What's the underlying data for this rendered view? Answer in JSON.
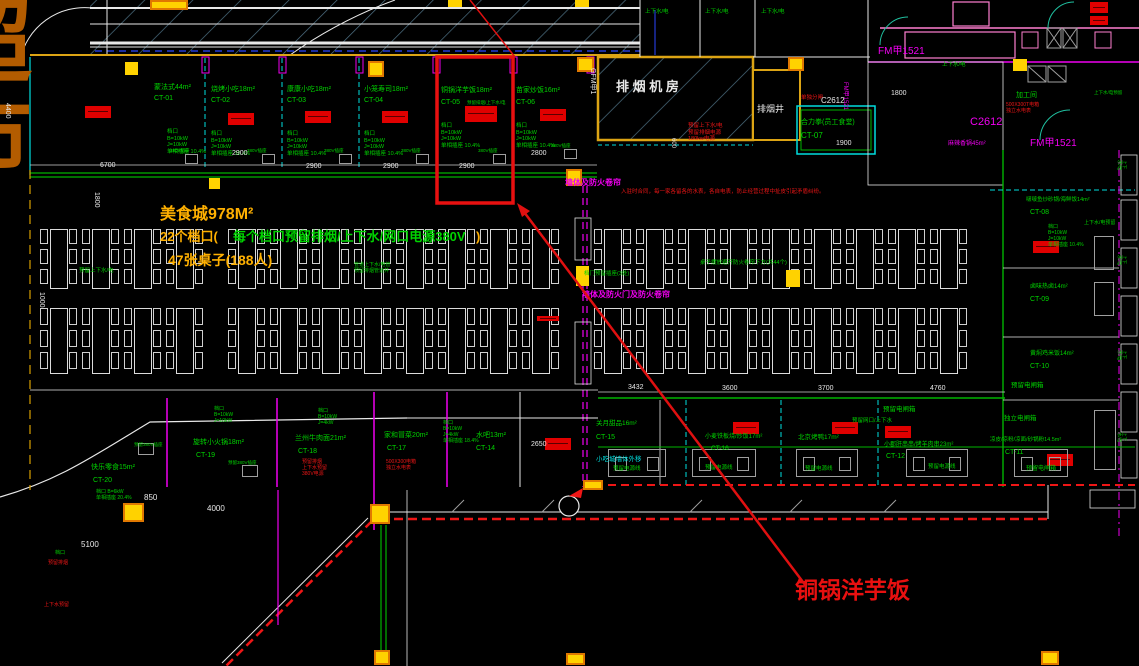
{
  "plan": {
    "width": 1139,
    "height": 666,
    "type": "food-court-floorplan"
  },
  "colors": {
    "green": "#00d300",
    "cyan": "#00dede",
    "magenta": "#f000f0",
    "red": "#ef1616",
    "white": "#e8e8e8",
    "yellow": "#ffb000",
    "orange": "#b35c00",
    "gray": "#b0b0b0",
    "pink": "#ff7fd0",
    "blue": "#2b46ff",
    "hatch": "#4f7386",
    "wall": "#dca414",
    "accent_red": "#e81010",
    "teal": "#20c0a0"
  },
  "highlight": {
    "stall": "铜锅洋芋饭",
    "box": {
      "x": 437,
      "y": 57,
      "w": 76,
      "h": 146
    }
  },
  "annotations": [
    {
      "n": "supermarket-char-1",
      "t": "超",
      "x": -60,
      "y": -12,
      "c": "orange",
      "s": 92,
      "b": true
    },
    {
      "n": "supermarket-char-2",
      "t": "市",
      "x": -60,
      "y": 84,
      "c": "orange",
      "s": 92,
      "b": true
    },
    {
      "n": "summary-line1",
      "t": "美食城978M²",
      "x": 160,
      "y": 205,
      "c": "yellow",
      "s": 16,
      "b": true
    },
    {
      "n": "summary-line2-prefix",
      "t": "22个档口(",
      "x": 160,
      "y": 229,
      "c": "yellow",
      "s": 13,
      "b": true
    },
    {
      "n": "summary-line2-green",
      "t": "每个档口预留排烟/上下水/网口电源380V",
      "x": 233,
      "y": 229,
      "c": "green",
      "s": 13,
      "b": true
    },
    {
      "n": "summary-line2-suffix",
      "t": ")",
      "x": 476,
      "y": 229,
      "c": "yellow",
      "s": 13,
      "b": true
    },
    {
      "n": "summary-line3",
      "t": "47张桌子(188人)",
      "x": 168,
      "y": 252,
      "c": "yellow",
      "s": 14,
      "b": true
    },
    {
      "n": "callout-label",
      "t": "铜锅洋芋饭",
      "x": 795,
      "y": 577,
      "c": "accent_red",
      "s": 23,
      "b": true
    },
    {
      "n": "stall-ct01-name",
      "t": "蒙法式44m²",
      "x": 154,
      "y": 84,
      "c": "green",
      "s": 7
    },
    {
      "n": "stall-ct01-code",
      "t": "CT-01",
      "x": 154,
      "y": 95,
      "c": "green",
      "s": 7
    },
    {
      "n": "stall-ct01-spec",
      "t": "档口\nB=10kW\nJ=10kW\n单相插座 10.4%",
      "x": 167,
      "y": 129,
      "c": "green",
      "s": 5.5
    },
    {
      "n": "stall-ct02-name",
      "t": "烧烤小吃18m²",
      "x": 211,
      "y": 86,
      "c": "green",
      "s": 7
    },
    {
      "n": "stall-ct02-code",
      "t": "CT-02",
      "x": 211,
      "y": 97,
      "c": "green",
      "s": 7
    },
    {
      "n": "stall-ct02-spec",
      "t": "档口\nB=10kW\nJ=10kW\n单相插座 10.4%",
      "x": 211,
      "y": 131,
      "c": "green",
      "s": 5.5
    },
    {
      "n": "stall-ct03-name",
      "t": "康康小吃18m²",
      "x": 287,
      "y": 86,
      "c": "green",
      "s": 7
    },
    {
      "n": "stall-ct03-code",
      "t": "CT-03",
      "x": 287,
      "y": 97,
      "c": "green",
      "s": 7
    },
    {
      "n": "stall-ct03-spec",
      "t": "档口\nB=10kW\nJ=10kW\n单相插座 10.4%",
      "x": 287,
      "y": 131,
      "c": "green",
      "s": 5.5
    },
    {
      "n": "stall-ct04-name",
      "t": "小笼寿司18m²",
      "x": 364,
      "y": 86,
      "c": "green",
      "s": 7
    },
    {
      "n": "stall-ct04-code",
      "t": "CT-04",
      "x": 364,
      "y": 97,
      "c": "green",
      "s": 7
    },
    {
      "n": "stall-ct04-spec",
      "t": "档口\nB=10kW\nJ=10kW\n单相插座 10.4%",
      "x": 364,
      "y": 131,
      "c": "green",
      "s": 5.5
    },
    {
      "n": "stall-ct05-name",
      "t": "铜锅洋芋饭18m²",
      "x": 441,
      "y": 87,
      "c": "green",
      "s": 7
    },
    {
      "n": "stall-ct05-code",
      "t": "CT-05",
      "x": 441,
      "y": 99,
      "c": "green",
      "s": 7
    },
    {
      "n": "stall-ct05-note",
      "t": "预留排烟/上下水/电",
      "x": 467,
      "y": 100,
      "c": "green",
      "s": 4.5
    },
    {
      "n": "stall-ct05-spec",
      "t": "档口\nB=10kW\nJ=10kW\n单相插座 10.4%",
      "x": 441,
      "y": 123,
      "c": "green",
      "s": 5.5
    },
    {
      "n": "stall-ct06-name",
      "t": "苗家炒饭16m²",
      "x": 516,
      "y": 87,
      "c": "green",
      "s": 7
    },
    {
      "n": "stall-ct06-code",
      "t": "CT-06",
      "x": 516,
      "y": 99,
      "c": "green",
      "s": 7
    },
    {
      "n": "stall-ct06-spec",
      "t": "档口\nB=10kW\nJ=10kW\n单相插座 10.4%",
      "x": 516,
      "y": 123,
      "c": "green",
      "s": 5.5
    },
    {
      "n": "socket-label-1",
      "t": "380V插座",
      "x": 170,
      "y": 148,
      "c": "green",
      "s": 4.5
    },
    {
      "n": "socket-label-2",
      "t": "380V插座",
      "x": 247,
      "y": 148,
      "c": "green",
      "s": 4.5
    },
    {
      "n": "socket-label-3",
      "t": "380V插座",
      "x": 324,
      "y": 148,
      "c": "green",
      "s": 4.5
    },
    {
      "n": "socket-label-4",
      "t": "380V插座",
      "x": 401,
      "y": 148,
      "c": "green",
      "s": 4.5
    },
    {
      "n": "socket-label-5",
      "t": "380V插座",
      "x": 478,
      "y": 148,
      "c": "green",
      "s": 4.5
    },
    {
      "n": "socket-label-6",
      "t": "380V插座",
      "x": 551,
      "y": 143,
      "c": "green",
      "s": 4.5
    },
    {
      "n": "exhaust-room-label",
      "t": "排 烟 机 房",
      "x": 616,
      "y": 79,
      "c": "white",
      "s": 13,
      "b": true
    },
    {
      "n": "exhaust-shaft-label",
      "t": "排烟井",
      "x": 757,
      "y": 104,
      "c": "white",
      "s": 9
    },
    {
      "n": "door-code-gfm",
      "t": "GFM甲1",
      "x": 596,
      "y": 68,
      "c": "white",
      "s": 7,
      "r": 90
    },
    {
      "n": "exhaust-notes",
      "t": "预留上下水/电\n预留排烟电源\n180kw电源",
      "x": 688,
      "y": 123,
      "c": "red",
      "s": 5.5
    },
    {
      "n": "canteen-name",
      "t": "合力拳(员工食堂)",
      "x": 801,
      "y": 119,
      "c": "green",
      "s": 7
    },
    {
      "n": "canteen-code",
      "t": "CT-07",
      "x": 801,
      "y": 131,
      "c": "green",
      "s": 8
    },
    {
      "n": "canteen-note",
      "t": "单独分闸",
      "x": 801,
      "y": 95,
      "c": "red",
      "s": 5.5
    },
    {
      "n": "window-c2612-a",
      "t": "C2612",
      "x": 821,
      "y": 96,
      "c": "white",
      "s": 8
    },
    {
      "n": "door-fm1521-a",
      "t": "FM甲1521",
      "x": 848,
      "y": 82,
      "c": "magenta",
      "s": 6,
      "r": 90
    },
    {
      "n": "dim-1900",
      "t": "1900",
      "x": 836,
      "y": 140,
      "c": "white",
      "s": 7
    },
    {
      "n": "corridor-utility-1",
      "t": "上下水/电",
      "x": 645,
      "y": 9,
      "c": "green",
      "s": 5.5
    },
    {
      "n": "corridor-utility-2",
      "t": "上下水/电",
      "x": 705,
      "y": 9,
      "c": "green",
      "s": 5.5
    },
    {
      "n": "corridor-utility-3",
      "t": "上下水/电",
      "x": 761,
      "y": 9,
      "c": "green",
      "s": 5.5
    },
    {
      "n": "door-fm1521-b",
      "t": "FM甲1521",
      "x": 878,
      "y": 46,
      "c": "magenta",
      "s": 10
    },
    {
      "n": "door-fm1521-c",
      "t": "FM甲1521",
      "x": 1030,
      "y": 138,
      "c": "magenta",
      "s": 10
    },
    {
      "n": "window-c2612-b",
      "t": "C2612",
      "x": 970,
      "y": 116,
      "c": "magenta",
      "s": 11
    },
    {
      "n": "dim-1800-a",
      "t": "1800",
      "x": 891,
      "y": 90,
      "c": "white",
      "s": 7
    },
    {
      "n": "prep-room-label",
      "t": "加工间",
      "x": 1016,
      "y": 92,
      "c": "green",
      "s": 7
    },
    {
      "n": "prep-room-note",
      "t": "500X300T电箱\n独立水电表",
      "x": 1006,
      "y": 102,
      "c": "red",
      "s": 5
    },
    {
      "n": "utility-a",
      "t": "上下水/电",
      "x": 942,
      "y": 62,
      "c": "green",
      "s": 5.5
    },
    {
      "n": "utility-b",
      "t": "上下水/电预留",
      "x": 1094,
      "y": 90,
      "c": "green",
      "s": 4.5
    },
    {
      "n": "hotpot-label",
      "t": "麻辣香锅45m²",
      "x": 948,
      "y": 141,
      "c": "magenta",
      "s": 6
    },
    {
      "n": "stall-ct08-name",
      "t": "啵啵鱼炒砂锅/海鲜饭14m²",
      "x": 1026,
      "y": 197,
      "c": "green",
      "s": 5.5
    },
    {
      "n": "stall-ct08-code",
      "t": "CT-08",
      "x": 1030,
      "y": 209,
      "c": "green",
      "s": 7
    },
    {
      "n": "stall-ct08-spec",
      "t": "档口\nB=10kW\nJ=10kW\n单相插座 10.4%",
      "x": 1048,
      "y": 224,
      "c": "green",
      "s": 5
    },
    {
      "n": "utility-c",
      "t": "上下水/电预留",
      "x": 1084,
      "y": 220,
      "c": "green",
      "s": 5
    },
    {
      "n": "stall-ct09-name",
      "t": "卤味热卤14m²",
      "x": 1030,
      "y": 284,
      "c": "green",
      "s": 6
    },
    {
      "n": "stall-ct09-code",
      "t": "CT-09",
      "x": 1030,
      "y": 296,
      "c": "green",
      "s": 7
    },
    {
      "n": "stall-ct10-name",
      "t": "黄焖鸡米饭14m²",
      "x": 1030,
      "y": 351,
      "c": "green",
      "s": 6
    },
    {
      "n": "stall-ct10-code",
      "t": "CT-10",
      "x": 1030,
      "y": 363,
      "c": "green",
      "s": 7
    },
    {
      "n": "breaker-a",
      "t": "预留电闸箱",
      "x": 1011,
      "y": 382,
      "c": "green",
      "s": 6.5
    },
    {
      "n": "breaker-b",
      "t": "独立电闸箱",
      "x": 1004,
      "y": 415,
      "c": "green",
      "s": 6.5
    },
    {
      "n": "stall-ct11-name",
      "t": "凉皮/凉粉/凉面/砂锅粉14.5m²",
      "x": 990,
      "y": 437,
      "c": "green",
      "s": 5.5
    },
    {
      "n": "stall-ct11-code",
      "t": "CT-11",
      "x": 1005,
      "y": 449,
      "c": "green",
      "s": 7
    },
    {
      "n": "breaker-c",
      "t": "预留电闸箱",
      "x": 1026,
      "y": 466,
      "c": "green",
      "s": 6
    },
    {
      "n": "tables-note",
      "t": "桌子摆放避开防火卷帘下方(共44个)",
      "x": 700,
      "y": 260,
      "c": "green",
      "s": 5.5
    },
    {
      "n": "sockets-note",
      "t": "档门预留插座(3处)",
      "x": 584,
      "y": 271,
      "c": "green",
      "s": 5.5
    },
    {
      "n": "utility-d",
      "t": "预留上下水/电",
      "x": 79,
      "y": 268,
      "c": "green",
      "s": 5.5
    },
    {
      "n": "pipes-note",
      "t": "管道上下水/电管\n预留排烟管道井",
      "x": 354,
      "y": 262,
      "c": "green",
      "s": 5
    },
    {
      "n": "shutter-note-a",
      "t": "墙体及防火卷帘",
      "x": 565,
      "y": 178,
      "c": "magenta",
      "s": 8,
      "b": true
    },
    {
      "n": "shutter-note-b",
      "t": "墙体及防火门及防火卷帘",
      "x": 582,
      "y": 290,
      "c": "magenta",
      "s": 8,
      "b": true
    },
    {
      "n": "wall-note",
      "t": "小吃城墙体外移",
      "x": 596,
      "y": 456,
      "c": "cyan",
      "s": 6.5
    },
    {
      "n": "contract-note",
      "t": "入驻时合同，每一家各留各的水表，各自电表，防止经营过程中扯皮引起矛盾纠纷。",
      "x": 621,
      "y": 189,
      "c": "red",
      "s": 5.5
    },
    {
      "n": "stall-ct20-name",
      "t": "快乐零食15m²",
      "x": 91,
      "y": 464,
      "c": "green",
      "s": 7
    },
    {
      "n": "stall-ct20-code",
      "t": "CT-20",
      "x": 93,
      "y": 477,
      "c": "green",
      "s": 7
    },
    {
      "n": "stall-ct20-spec",
      "t": "档口 B=6kW\n单相插座 20.4%",
      "x": 96,
      "y": 489,
      "c": "green",
      "s": 5
    },
    {
      "n": "stall-ct19-name",
      "t": "旋转小火锅18m²",
      "x": 193,
      "y": 439,
      "c": "green",
      "s": 7
    },
    {
      "n": "stall-ct19-code",
      "t": "CT-19",
      "x": 196,
      "y": 452,
      "c": "green",
      "s": 7
    },
    {
      "n": "stall-ct19-spec",
      "t": "档口\nB=10kW\nJ=10kW",
      "x": 214,
      "y": 406,
      "c": "green",
      "s": 5
    },
    {
      "n": "stall-ct18-name",
      "t": "兰州牛肉面21m²",
      "x": 295,
      "y": 435,
      "c": "green",
      "s": 7
    },
    {
      "n": "stall-ct18-code",
      "t": "CT-18",
      "x": 298,
      "y": 448,
      "c": "green",
      "s": 7
    },
    {
      "n": "stall-ct18-note",
      "t": "预留排烟\n上下水预留\n380V电源",
      "x": 302,
      "y": 459,
      "c": "red",
      "s": 5
    },
    {
      "n": "stall-ct18-spec",
      "t": "档口\nB=10kW\nJ=4kW",
      "x": 318,
      "y": 408,
      "c": "green",
      "s": 5
    },
    {
      "n": "stall-ct17-name",
      "t": "家和冒菜20m²",
      "x": 384,
      "y": 432,
      "c": "green",
      "s": 7
    },
    {
      "n": "stall-ct17-code",
      "t": "CT-17",
      "x": 387,
      "y": 445,
      "c": "green",
      "s": 7
    },
    {
      "n": "stall-ct17-note",
      "t": "500X300电箱\n独立水电表",
      "x": 386,
      "y": 459,
      "c": "red",
      "s": 5
    },
    {
      "n": "stall-ct14-name",
      "t": "水吧13m²",
      "x": 476,
      "y": 432,
      "c": "green",
      "s": 7
    },
    {
      "n": "stall-ct14-code",
      "t": "CT-14",
      "x": 476,
      "y": 445,
      "c": "green",
      "s": 7
    },
    {
      "n": "stall-ct14-spec",
      "t": "档口\nB=10kW\nJ=4kW\n单相插座 18.4%",
      "x": 443,
      "y": 420,
      "c": "green",
      "s": 5
    },
    {
      "n": "dim-2650",
      "t": "2650",
      "x": 531,
      "y": 441,
      "c": "white",
      "s": 7
    },
    {
      "n": "stall-ct15-name",
      "t": "关月甜品16m²",
      "x": 596,
      "y": 420,
      "c": "green",
      "s": 6.5
    },
    {
      "n": "stall-ct15-code",
      "t": "CT-15",
      "x": 596,
      "y": 434,
      "c": "green",
      "s": 7
    },
    {
      "n": "stall-ct16-name",
      "t": "小麦铁板烧/炒饭17m²",
      "x": 705,
      "y": 434,
      "c": "green",
      "s": 6
    },
    {
      "n": "stall-ct16-code",
      "t": "CT-16",
      "x": 711,
      "y": 445,
      "c": "green",
      "s": 6.5
    },
    {
      "n": "stall-duck-name",
      "t": "北京烤鸭17m²",
      "x": 798,
      "y": 434,
      "c": "green",
      "s": 6.5
    },
    {
      "n": "stall-ct12-name",
      "t": "小郡肝串串/烤羊肉串23m²",
      "x": 884,
      "y": 442,
      "c": "green",
      "s": 6
    },
    {
      "n": "stall-ct12-code",
      "t": "CT-12",
      "x": 886,
      "y": 453,
      "c": "green",
      "s": 7
    },
    {
      "n": "breaker-d",
      "t": "预留电闸箱",
      "x": 883,
      "y": 406,
      "c": "green",
      "s": 6.5
    },
    {
      "n": "netport-note",
      "t": "预留网口/上下水",
      "x": 852,
      "y": 418,
      "c": "green",
      "s": 5.5
    },
    {
      "n": "power-label-1",
      "t": "预留电源线",
      "x": 613,
      "y": 466,
      "c": "green",
      "s": 5.5
    },
    {
      "n": "power-label-2",
      "t": "预留电源线",
      "x": 705,
      "y": 465,
      "c": "green",
      "s": 5.5
    },
    {
      "n": "power-label-3",
      "t": "预留电源线",
      "x": 805,
      "y": 466,
      "c": "green",
      "s": 5.5
    },
    {
      "n": "power-label-4",
      "t": "预留电源线",
      "x": 928,
      "y": 464,
      "c": "green",
      "s": 5.5
    },
    {
      "n": "utility-e",
      "t": "预留380V插座",
      "x": 134,
      "y": 442,
      "c": "green",
      "s": 4.5
    },
    {
      "n": "utility-f",
      "t": "预留380V插座",
      "x": 228,
      "y": 460,
      "c": "green",
      "s": 4.5
    },
    {
      "n": "dim-6700",
      "t": "6700",
      "x": 100,
      "y": 162,
      "c": "white",
      "s": 7
    },
    {
      "n": "dim-2900-a",
      "t": "2900",
      "x": 232,
      "y": 150,
      "c": "white",
      "s": 7
    },
    {
      "n": "dim-2900-b",
      "t": "2900",
      "x": 306,
      "y": 163,
      "c": "white",
      "s": 7
    },
    {
      "n": "dim-2900-c",
      "t": "2900",
      "x": 383,
      "y": 163,
      "c": "white",
      "s": 7
    },
    {
      "n": "dim-2900-d",
      "t": "2900",
      "x": 459,
      "y": 163,
      "c": "white",
      "s": 7
    },
    {
      "n": "dim-2800",
      "t": "2800",
      "x": 531,
      "y": 150,
      "c": "white",
      "s": 7
    },
    {
      "n": "dim-3432",
      "t": "3432",
      "x": 628,
      "y": 384,
      "c": "white",
      "s": 7
    },
    {
      "n": "dim-3600",
      "t": "3600",
      "x": 722,
      "y": 385,
      "c": "white",
      "s": 7
    },
    {
      "n": "dim-3700",
      "t": "3700",
      "x": 818,
      "y": 385,
      "c": "white",
      "s": 7
    },
    {
      "n": "dim-4760",
      "t": "4760",
      "x": 930,
      "y": 385,
      "c": "white",
      "s": 7
    },
    {
      "n": "dim-4000",
      "t": "4000",
      "x": 207,
      "y": 504,
      "c": "white",
      "s": 8
    },
    {
      "n": "dim-850",
      "t": "850",
      "x": 144,
      "y": 493,
      "c": "white",
      "s": 8
    },
    {
      "n": "dim-5100",
      "t": "5100",
      "x": 81,
      "y": 540,
      "c": "white",
      "s": 8
    },
    {
      "n": "dim-1800-b",
      "t": "1800",
      "x": 100,
      "y": 192,
      "c": "white",
      "s": 7,
      "r": 90
    },
    {
      "n": "dim-4400",
      "t": "4400",
      "x": 11,
      "y": 103,
      "c": "white",
      "s": 7,
      "r": 90
    },
    {
      "n": "dim-1000",
      "t": "1000",
      "x": 45,
      "y": 292,
      "c": "white",
      "s": 7,
      "r": 90
    },
    {
      "n": "dim-600",
      "t": "600",
      "x": 676,
      "y": 138,
      "c": "white",
      "s": 6,
      "r": 90
    },
    {
      "n": "misc-a",
      "t": "预留排烟",
      "x": 48,
      "y": 560,
      "c": "red",
      "s": 5
    },
    {
      "n": "misc-b",
      "t": "上下水预留",
      "x": 44,
      "y": 602,
      "c": "red",
      "s": 5
    },
    {
      "n": "misc-c",
      "t": "档口",
      "x": 55,
      "y": 550,
      "c": "green",
      "s": 5
    },
    {
      "n": "edge-utility-1",
      "t": "上下水/电",
      "x": 1127,
      "y": 160,
      "c": "green",
      "s": 4.5,
      "r": 90
    },
    {
      "n": "edge-utility-2",
      "t": "上下水/电",
      "x": 1127,
      "y": 255,
      "c": "green",
      "s": 4.5,
      "r": 90
    },
    {
      "n": "edge-utility-3",
      "t": "上下水/电",
      "x": 1127,
      "y": 350,
      "c": "green",
      "s": 4.5,
      "r": 90
    },
    {
      "n": "edge-utility-4",
      "t": "上下水/电",
      "x": 1127,
      "y": 432,
      "c": "green",
      "s": 4.5,
      "r": 90
    }
  ]
}
